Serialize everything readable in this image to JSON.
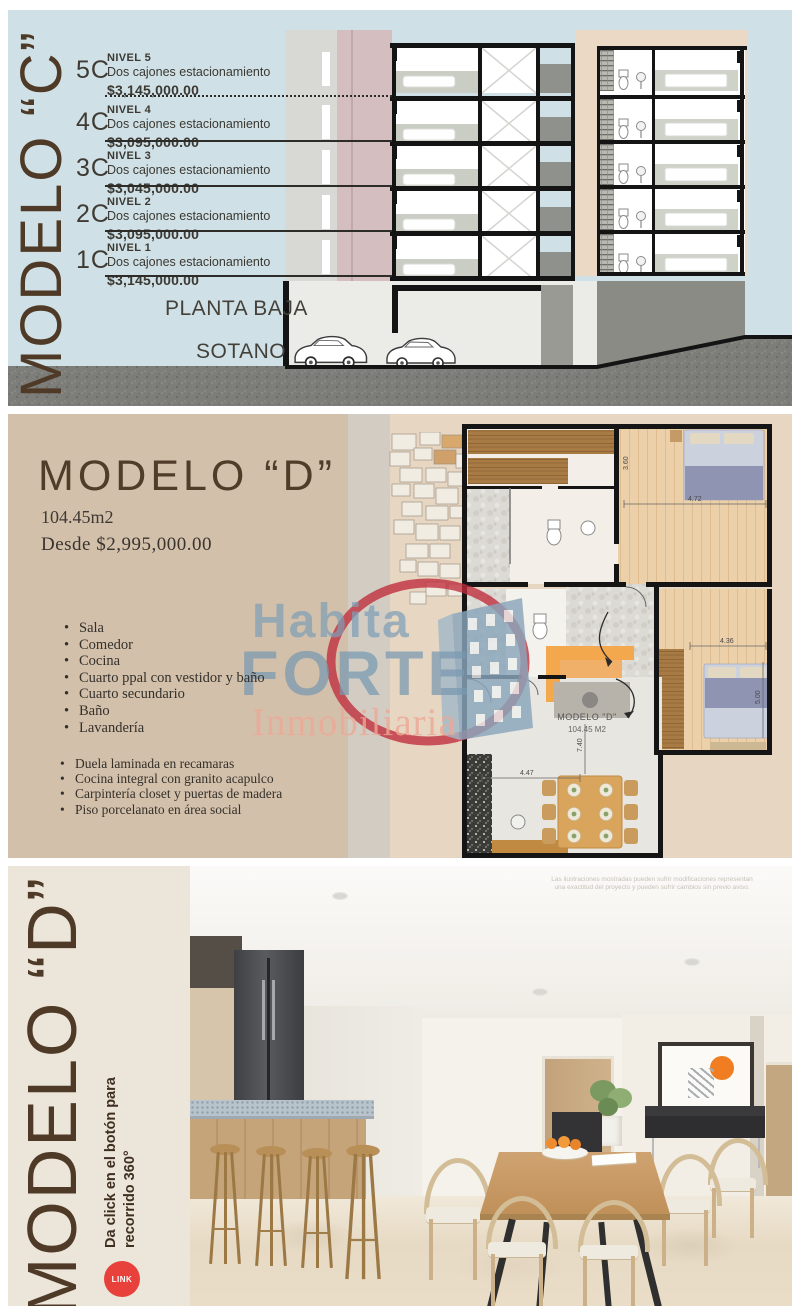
{
  "section_c": {
    "title": "MODELO “C”",
    "floors": [
      {
        "code": "5C",
        "nivel": "NIVEL 5",
        "desc": "Dos cajones estacionamiento",
        "price": "$3,145,000.00"
      },
      {
        "code": "4C",
        "nivel": "NIVEL 4",
        "desc": "Dos cajones estacionamiento",
        "price": "$3,095,000.00"
      },
      {
        "code": "3C",
        "nivel": "NIVEL 3",
        "desc": "Dos cajones estacionamiento",
        "price": "$3,045,000.00"
      },
      {
        "code": "2C",
        "nivel": "NIVEL 2",
        "desc": "Dos cajones estacionamiento",
        "price": "$3,095,000.00"
      },
      {
        "code": "1C",
        "nivel": "NIVEL 1",
        "desc": "Dos cajones estacionamiento",
        "price": "$3,145,000.00"
      }
    ],
    "planta_baja": "PLANTA BAJA",
    "sotano": "SOTANO"
  },
  "section_d": {
    "title": "MODELO “D”",
    "area": "104.45m2",
    "price": "Desde $2,995,000.00",
    "features": [
      "Sala",
      "Comedor",
      "Cocina",
      "Cuarto ppal con vestidor y baño",
      "Cuarto secundario",
      "Baño",
      "Lavandería"
    ],
    "finishes": [
      "Duela laminada en recamaras",
      "Cocina integral con granito acapulco",
      "Carpintería closet y puertas de madera",
      "Piso porcelanato en área social"
    ],
    "plan": {
      "label": "MODELO \"D\"",
      "area": "104.45 M2",
      "dims": {
        "bed1_w": "4.72",
        "bed1_h": "3.60",
        "bed2_w": "4.36",
        "bed2_h": "5.00",
        "living_w": "4.47",
        "living_h": "7.40"
      }
    }
  },
  "logo": {
    "habita": "Habita",
    "forte": "FORTE",
    "tagline": "Inmobiliaria"
  },
  "render": {
    "title": "MODELO “D”",
    "cta_line1": "Da click en el botón para",
    "cta_line2": "recorrido 360°",
    "link": "LINK",
    "disclaimer1": "Las ilustraciones mostradas pueden sufrir modificaciones representan",
    "disclaimer2": "una exactitud del proyecto y pueden sufrir cambios sin previo aviso."
  },
  "colors": {
    "brown_text": "#4e3a27",
    "blue_bg": "#cfe1e6",
    "tan_bg": "#d3c0ab",
    "pale_bg": "#e6d6c2",
    "cream_bg": "#ece5d9",
    "link_red": "#e8403a",
    "logo_blue": "#7f9fb6",
    "logo_salmon": "#eda996",
    "arc_red": "#c02c3c",
    "sofa_orange": "#f3a84e",
    "art_orange": "#f07d22"
  }
}
